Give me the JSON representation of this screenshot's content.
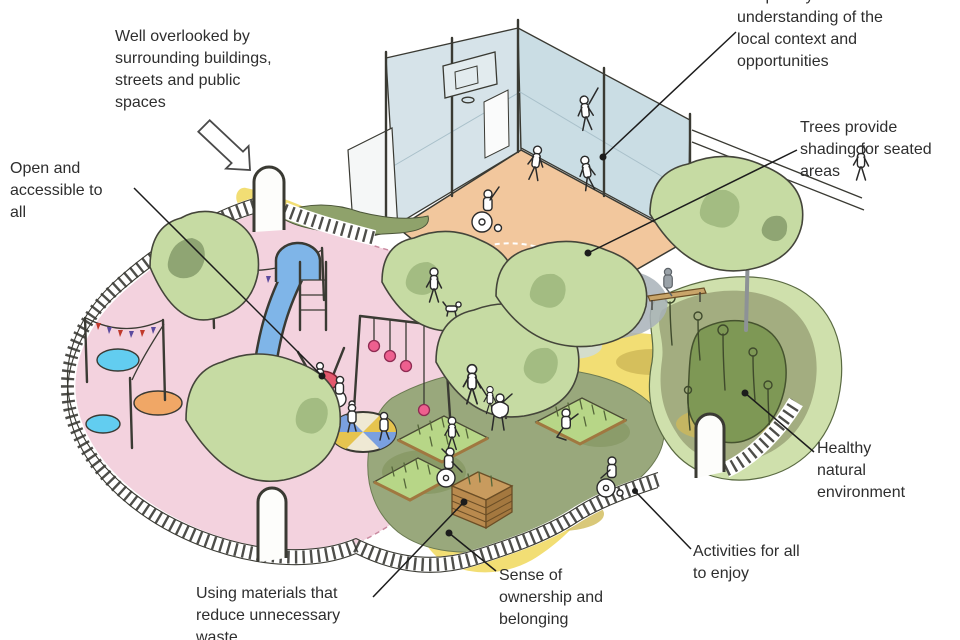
{
  "diagram": {
    "scene": "isometric-sketch-of-inclusive-playground-park",
    "annotations": {
      "well_overlooked": "Well overlooked by surrounding buildings, streets and public spaces",
      "open_accessible": "Open and accessible to all",
      "shaped_by_context": "Shaped by an understanding of the local context and opportunities",
      "trees_shading": "Trees provide shading for seated areas",
      "healthy_natural": "Healthy natural environment",
      "activities_for_all": "Activities for all to enjoy",
      "sense_of_ownership": "Sense of ownership and belonging",
      "using_materials": "Using materials that reduce unnecessary waste"
    },
    "icons": {
      "overlook_arrow": "down-right-outline-arrow",
      "leader_line_end": "filled-dot"
    },
    "colors": {
      "label_text": "#2e2e2e",
      "leader_line": "#1c1c1c",
      "playground_surface": "#f3d2de",
      "path_yellow": "#f2de74",
      "path_mustard": "#d0ba58",
      "tree_canopy": "#c6dba3",
      "tree_canopy_shadow": "#a3bc82",
      "court_floor": "#f2c79d",
      "court_wall": "#d6e3e9",
      "garden_ground": "#99a87c",
      "shrub_dark": "#7e9855",
      "natural_fringe": "#cfe0ac",
      "slide_blue": "#7fb5e8",
      "pond_cyan": "#62cdf0",
      "basket_swing_red": "#e4596e",
      "swing_ball_pink": "#ee5f8f",
      "sand_oval_orange": "#f0a766",
      "crate_wood": "#b98a4e",
      "shade_grey": "#a8b1b8"
    }
  }
}
